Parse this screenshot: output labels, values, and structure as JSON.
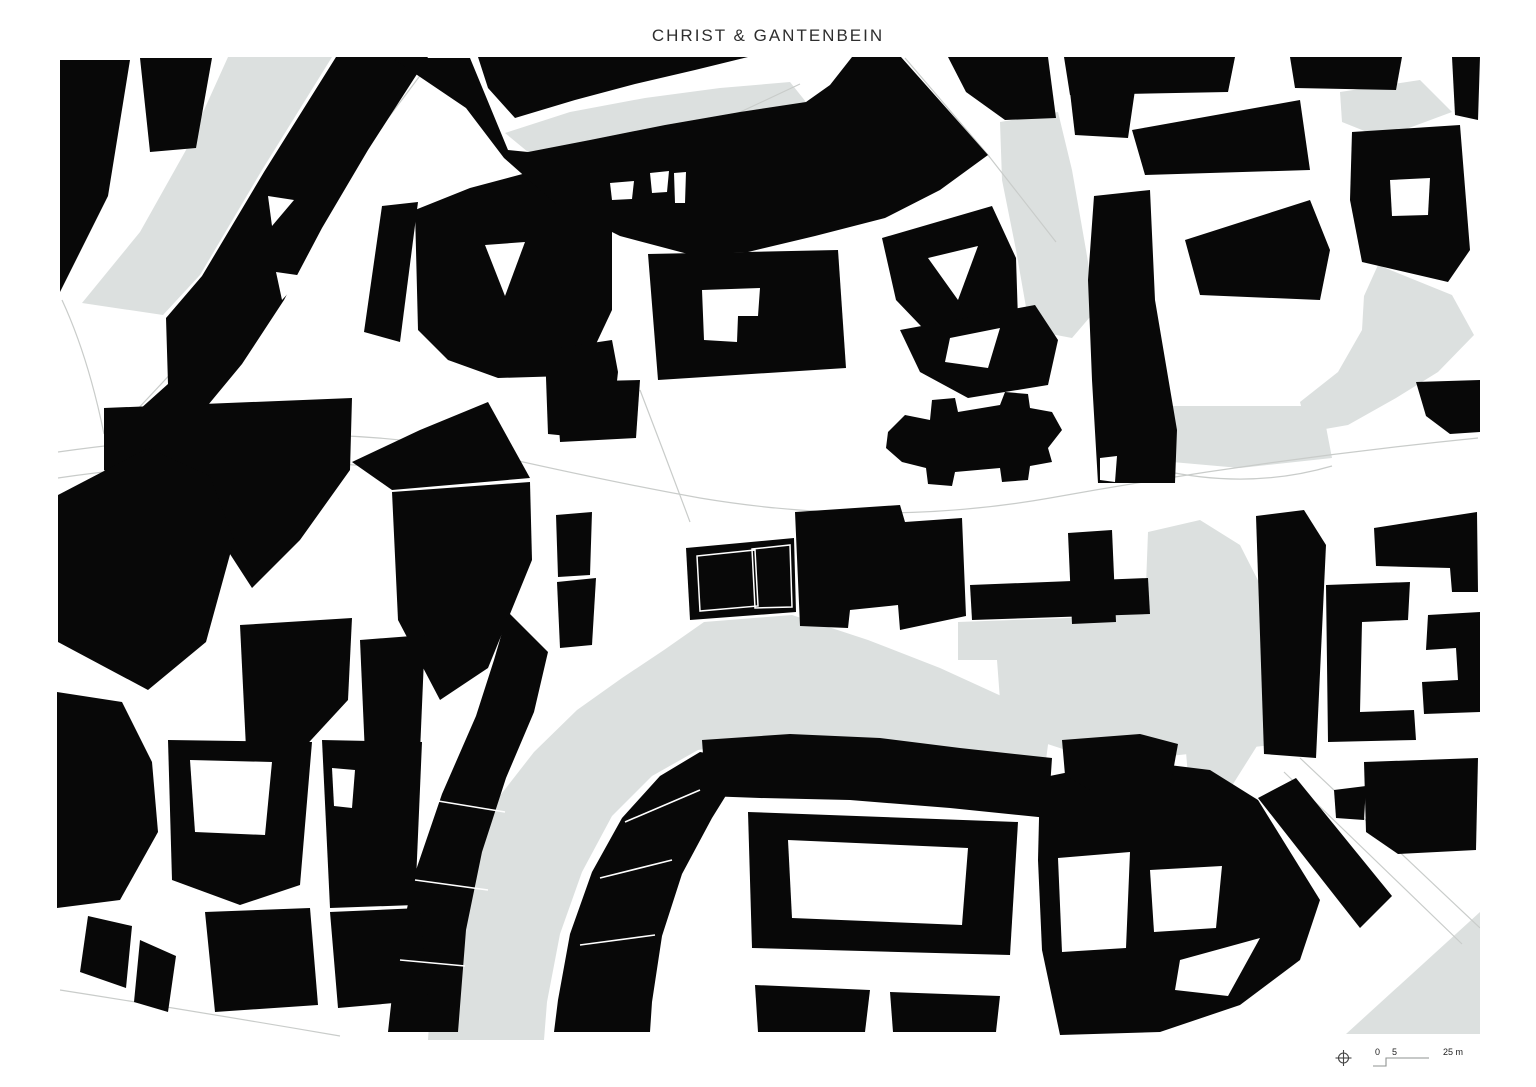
{
  "title": "CHRIST & GANTENBEIN",
  "colors": {
    "background": "#ffffff",
    "building": "#080808",
    "open_space": "#dce0df",
    "street_line": "#c9ccca",
    "title_text": "#2e2e2e",
    "scale_text": "#222222",
    "scale_line": "#8f9392"
  },
  "scale_bar": {
    "zero": "0",
    "five": "5",
    "max": "25 m"
  },
  "map": {
    "clip": [
      57,
      55,
      1423,
      985
    ],
    "gray_shapes": [
      {
        "n": "open-space",
        "p": "228,57 332,57 262,170 200,275 163,315 82,303 140,232 186,150"
      },
      {
        "n": "open-space",
        "p": "505,133 570,112 645,98 720,88 790,82 806,102 740,112 665,125 590,140 528,152"
      },
      {
        "n": "open-space",
        "p": "1000,122 1058,112 1072,170 1086,250 1096,310 1072,338 1030,330 1016,250 1002,180"
      },
      {
        "n": "open-space",
        "p": "1340,92 1420,80 1452,112 1382,138 1342,122"
      },
      {
        "n": "open-space",
        "p": "1378,265 1452,295 1474,335 1438,372 1396,398 1348,425 1308,432 1300,402 1338,372 1362,330 1364,296"
      },
      {
        "n": "plaza-area",
        "p": "1163,406 1322,406 1332,458 1240,468 1172,462"
      },
      {
        "n": "plaza-area",
        "p": "958,622 1068,618 1145,612 1148,532 1200,520 1240,545 1272,608 1290,692 1272,745 1170,756 1072,752 1020,735 1000,700 997,660 958,660"
      },
      {
        "n": "river-band",
        "p": "622,678 664,650 704,622 792,615 868,640 940,668 1010,700 1052,714 1046,760 976,764 900,748 826,742 756,742 698,750 652,776 612,816 582,872 560,934 547,1002 544,1040 428,1040 433,956 458,874 492,806 534,752 577,710"
      },
      {
        "n": "open-space",
        "p": "1346,1034 1480,912 1480,1034"
      },
      {
        "n": "open-space",
        "p": "1185,740 1262,738 1228,792 1188,776"
      }
    ],
    "hairlines": [
      {
        "n": "street-hairline",
        "d": "M430,62 Q300,240 112,436"
      },
      {
        "n": "street-hairline",
        "d": "M58,452 Q300,418 470,450 Q600,480 700,498 Q880,528 1050,498 Q1260,460 1478,438"
      },
      {
        "n": "street-hairline",
        "d": "M58,478 Q250,450 430,472"
      },
      {
        "n": "street-hairline",
        "d": "M905,58 L988,155 L1056,242"
      },
      {
        "n": "street-hairline",
        "d": "M548,200 Q660,150 800,84"
      },
      {
        "n": "street-hairline",
        "d": "M1160,470 Q1250,490 1332,466"
      },
      {
        "n": "street-hairline",
        "d": "M1300,758 L1480,928"
      },
      {
        "n": "street-hairline",
        "d": "M1284,772 L1462,944"
      },
      {
        "n": "street-hairline",
        "d": "M62,300 Q88,356 104,434"
      },
      {
        "n": "street-hairline",
        "d": "M60,990 Q200,1012 340,1036"
      },
      {
        "n": "street-hairline",
        "d": "M640,390 Q665,455 690,522"
      }
    ],
    "black_shapes": [
      {
        "n": "building-footprint",
        "p": "60,60 130,60 108,196 60,292"
      },
      {
        "n": "building-footprint",
        "p": "140,58 212,58 196,148 150,152"
      },
      {
        "n": "building-footprint",
        "p": "336,57 428,57 368,150 322,228 284,300 242,364 194,422 146,464 110,436 168,384 166,318 202,276 264,172"
      },
      {
        "n": "building-footprint",
        "p": "382,206 418,202 400,342 364,332"
      },
      {
        "n": "building-footprint",
        "p": "104,408 352,398 350,470 300,540 252,588 208,520 150,500 104,470"
      },
      {
        "n": "building-footprint",
        "p": "58,495 148,448 210,476 234,540 206,642 148,690 58,642"
      },
      {
        "n": "building-footprint",
        "p": "57,692 122,702 152,762 158,832 120,900 57,908"
      },
      {
        "n": "building-footprint",
        "p": "88,916 132,926 126,988 80,972"
      },
      {
        "n": "building-footprint",
        "p": "140,940 176,956 168,1012 134,1002"
      },
      {
        "n": "building-footprint",
        "p": "415,210 470,188 530,172 588,180 612,196 612,310 596,344 566,376 498,378 448,360 418,330"
      },
      {
        "n": "building-footprint",
        "p": "545,350 612,340 618,372 614,408 588,438 548,434"
      },
      {
        "n": "building-footprint",
        "p": "556,382 640,380 636,438 560,442"
      },
      {
        "n": "building-footprint",
        "p": "478,57 748,57 695,70 635,84 575,100 515,118 488,88"
      },
      {
        "n": "building-footprint",
        "p": "392,58 470,58 508,150 528,152 590,140 665,125 740,112 806,102 830,85 852,57 901,57 988,155 940,190 885,218 815,236 748,252 688,254 620,236 556,204 504,158 466,108"
      },
      {
        "n": "building-footprint",
        "p": "948,57 1048,57 1056,118 1005,120 966,92"
      },
      {
        "n": "building-footprint",
        "p": "648,254 838,250 846,368 658,380"
      },
      {
        "n": "building-footprint",
        "p": "882,238 992,206 1016,258 1018,320 942,348 896,300"
      },
      {
        "n": "building-footprint",
        "p": "900,330 1035,305 1058,340 1048,385 968,398 920,372"
      },
      {
        "n": "cathedral-footprint",
        "p": "888,432 905,415 930,420 932,400 955,398 958,412 1000,405 1005,392 1028,394 1030,408 1052,412 1062,430 1048,448 1052,462 1030,466 1028,480 1002,482 1000,468 955,472 952,486 928,484 926,468 902,462 886,448"
      },
      {
        "n": "building-footprint",
        "p": "1094,196 1150,190 1155,300 1177,430 1175,483 1098,483 1092,380 1088,280"
      },
      {
        "n": "building-footprint",
        "p": "1132,130 1300,100 1310,170 1145,175"
      },
      {
        "n": "building-footprint",
        "p": "1185,240 1310,200 1330,250 1320,300 1200,295"
      },
      {
        "n": "building-footprint",
        "p": "1290,57 1402,57 1396,90 1295,88"
      },
      {
        "n": "building-footprint",
        "p": "1452,57 1480,57 1478,120 1455,115"
      },
      {
        "n": "building-footprint",
        "p": "1064,57 1235,57 1228,92 1070,95"
      },
      {
        "n": "building-footprint",
        "p": "1070,92 1135,90 1128,138 1075,135"
      },
      {
        "n": "building-footprint",
        "p": "1352,132 1460,125 1470,250 1448,282 1362,262 1350,200"
      },
      {
        "n": "building-footprint",
        "p": "1416,382 1480,380 1480,432 1450,434 1426,416"
      },
      {
        "n": "building-footprint",
        "p": "1374,528 1477,512 1478,592 1452,592 1450,568 1376,566"
      },
      {
        "n": "building-footprint",
        "p": "1326,585 1410,582 1408,620 1362,622 1360,712 1414,710 1416,740 1328,742"
      },
      {
        "n": "building-footprint",
        "p": "1428,615 1480,612 1480,712 1424,714 1422,682 1458,680 1456,648 1426,650"
      },
      {
        "n": "building-footprint",
        "p": "1256,516 1304,510 1326,545 1316,758 1264,754"
      },
      {
        "n": "building-footprint",
        "p": "970,585 1148,578 1150,614 972,620"
      },
      {
        "n": "building-footprint",
        "p": "1068,533 1112,530 1116,622 1072,624"
      },
      {
        "n": "building-footprint",
        "p": "795,512 900,505 905,522 962,518 966,616 900,630 898,605 850,610 848,628 800,626"
      },
      {
        "n": "project-building",
        "p": "686,548 794,538 796,612 690,620"
      },
      {
        "n": "building-footprint",
        "p": "556,515 592,512 590,575 558,577"
      },
      {
        "n": "building-footprint",
        "p": "557,582 596,578 592,645 560,648"
      },
      {
        "n": "building-footprint",
        "p": "392,492 530,482 532,560 488,668 440,700 398,620"
      },
      {
        "n": "building-footprint",
        "p": "352,462 420,430 488,402 530,478 392,490"
      },
      {
        "n": "building-footprint",
        "p": "240,625 352,618 348,700 300,752 246,748"
      },
      {
        "n": "building-footprint",
        "p": "360,640 425,635 420,752 365,755"
      },
      {
        "n": "building-footprint",
        "p": "508,612 548,652 534,712 506,778 482,852 466,930 458,1032 388,1032 396,960 414,876 442,794 476,716 494,660"
      },
      {
        "n": "building-footprint",
        "p": "168,740 312,742 300,885 240,905 172,880"
      },
      {
        "n": "building-footprint",
        "p": "322,740 422,742 415,905 330,908"
      },
      {
        "n": "building-footprint",
        "p": "205,912 310,908 318,1005 215,1012"
      },
      {
        "n": "building-footprint",
        "p": "330,912 420,908 428,1000 338,1008"
      },
      {
        "n": "building-footprint",
        "p": "660,776 700,752 748,760 712,818 682,874 662,936 652,1002 650,1032 554,1032 558,1000 570,934 592,872 622,818"
      },
      {
        "n": "building-footprint",
        "p": "702,740 790,734 880,738 960,748 1052,758 1048,818 950,808 850,800 760,798 706,796"
      },
      {
        "n": "building-footprint",
        "p": "748,812 1018,822 1010,955 752,948"
      },
      {
        "n": "building-footprint",
        "p": "755,985 870,990 865,1032 758,1032"
      },
      {
        "n": "building-footprint",
        "p": "890,992 1000,996 996,1032 893,1032"
      },
      {
        "n": "building-footprint",
        "p": "1040,778 1128,760 1210,770 1258,800 1320,900 1300,960 1240,1005 1160,1032 1060,1035 1042,950 1038,860"
      },
      {
        "n": "building-footprint",
        "p": "1258,798 1296,778 1392,896 1360,928"
      },
      {
        "n": "building-footprint",
        "p": "1364,762 1478,758 1476,850 1398,854 1366,832"
      },
      {
        "n": "building-footprint",
        "p": "1334,790 1366,786 1364,820 1336,818"
      },
      {
        "n": "building-footprint",
        "p": "1062,740 1140,734 1178,744 1170,788 1090,790 1065,775"
      }
    ],
    "white_shapes": [
      {
        "n": "courtyard",
        "p": "268,196 294,200 272,226"
      },
      {
        "n": "courtyard",
        "p": "276,272 304,276 282,300"
      },
      {
        "n": "courtyard",
        "p": "485,245 525,242 505,296"
      },
      {
        "n": "courtyard",
        "p": "610,183 634,181 632,199 612,200"
      },
      {
        "n": "courtyard",
        "p": "650,173 669,171 667,192 652,193"
      },
      {
        "n": "courtyard",
        "p": "674,173 686,172 685,203 675,203"
      },
      {
        "n": "courtyard",
        "p": "702,290 760,288 758,316 738,316 737,342 704,340"
      },
      {
        "n": "courtyard",
        "p": "928,258 978,246 958,300"
      },
      {
        "n": "courtyard",
        "p": "950,338 1000,328 988,368 945,362"
      },
      {
        "n": "courtyard",
        "p": "1100,458 1117,456 1115,482 1100,480"
      },
      {
        "n": "courtyard",
        "p": "1390,180 1430,178 1428,215 1392,216"
      },
      {
        "n": "courtyard",
        "p": "190,760 272,762 265,835 195,832"
      },
      {
        "n": "courtyard",
        "p": "332,768 355,770 352,808 334,806"
      },
      {
        "n": "courtyard",
        "p": "788,840 968,848 962,925 792,918"
      },
      {
        "n": "courtyard",
        "p": "1058,858 1130,852 1126,948 1062,952"
      },
      {
        "n": "courtyard",
        "p": "1150,870 1222,866 1216,928 1154,932"
      },
      {
        "n": "courtyard",
        "p": "1180,960 1260,938 1228,996 1175,990"
      }
    ],
    "white_lines": [
      {
        "n": "parcel-line",
        "d": "M432,800 L505,812"
      },
      {
        "n": "parcel-line",
        "d": "M415,880 L488,890"
      },
      {
        "n": "parcel-line",
        "d": "M400,960 L465,966"
      },
      {
        "n": "parcel-line",
        "d": "M700,790 L625,822"
      },
      {
        "n": "parcel-line",
        "d": "M672,860 L600,878"
      },
      {
        "n": "parcel-line",
        "d": "M655,935 L580,945"
      }
    ],
    "project_outlines": [
      {
        "n": "project-building-outline",
        "p": "697,556 755,550 758,606 700,611"
      },
      {
        "n": "project-building-outline",
        "p": "752,549 790,545 792,607 755,608"
      }
    ]
  }
}
